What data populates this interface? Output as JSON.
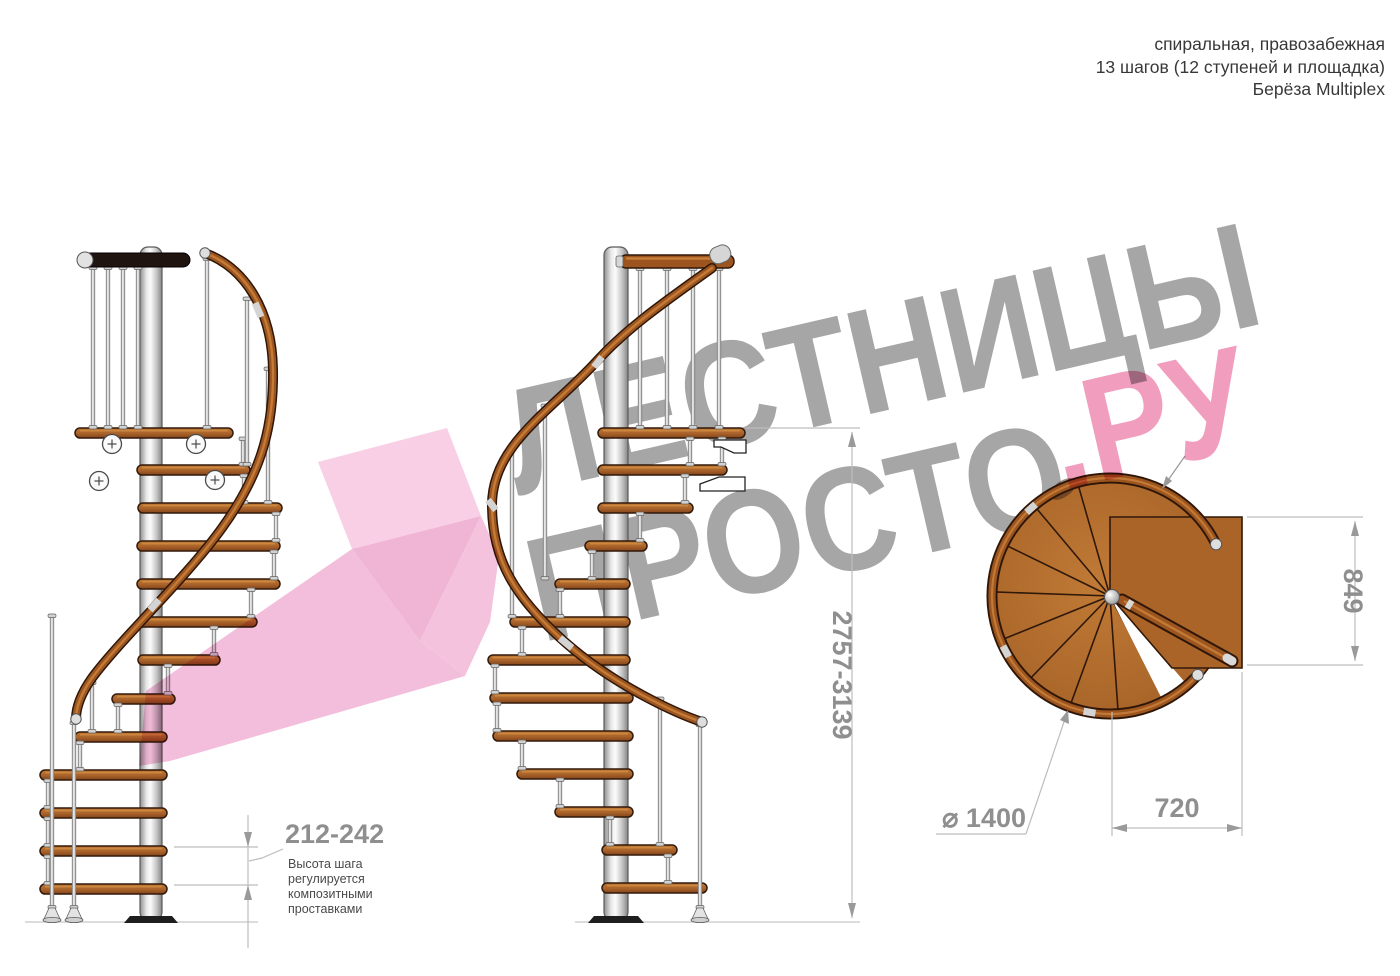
{
  "header": {
    "line1": "спиральная, правозабежная",
    "line2": "13 шагов (12 ступеней и площадка)",
    "line3": "Берёза Multiplex"
  },
  "watermark": {
    "word1": "ЛЕСТНИЦЫ",
    "word2": "ПРОСТО",
    "word3": ".РУ",
    "gray_color": "#a6a6a6",
    "pink_color": "#f08fb4",
    "arrow_pink_color": "#f2b5d6"
  },
  "dimensions": {
    "step_height": "212-242",
    "total_height": "2757-3139",
    "platform_depth": "849",
    "platform_width": "720",
    "diameter": "⌀ 1400"
  },
  "note": {
    "line1": "Высота шага",
    "line2": "регулируется",
    "line3": "композитными",
    "line4": "проставками"
  },
  "materials": {
    "tread_color": "#a8622a",
    "handrail_color": "#9c551f",
    "pole_color": "#d9d9d9"
  }
}
